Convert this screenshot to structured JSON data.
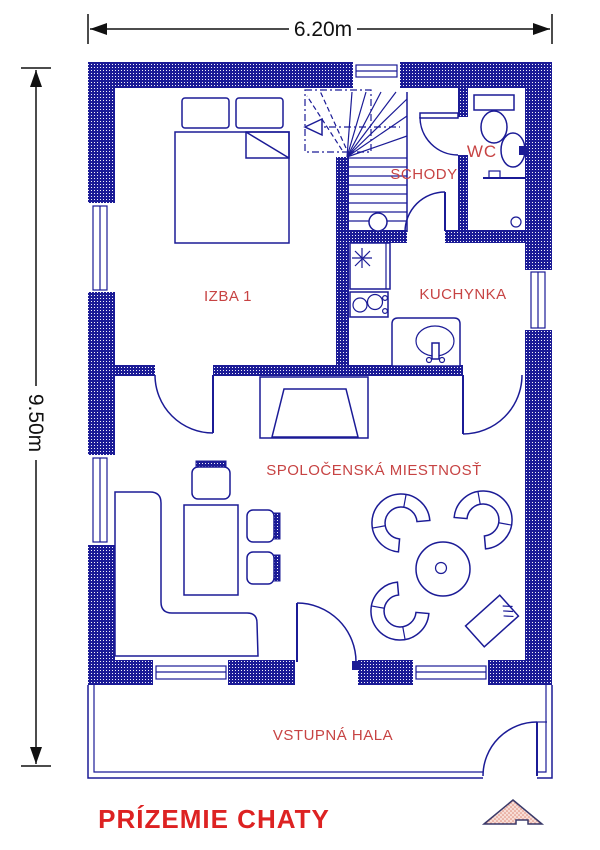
{
  "plan_title": "PRÍZEMIE CHATY",
  "dimensions": {
    "width": "6.20m",
    "height": "9.50m"
  },
  "rooms": {
    "bedroom": "IZBA 1",
    "stairs": "SCHODY",
    "wc": "WC",
    "kitchen": "KUCHYNKA",
    "living_room": "SPOLOČENSKÁ MIESTNOSŤ",
    "entry_hall": "VSTUPNÁ HALA"
  },
  "colors": {
    "wall_navy": "#1b1b96",
    "room_label_red": "#c74343",
    "title_red": "#dd2222",
    "dimension_black": "#111111"
  }
}
